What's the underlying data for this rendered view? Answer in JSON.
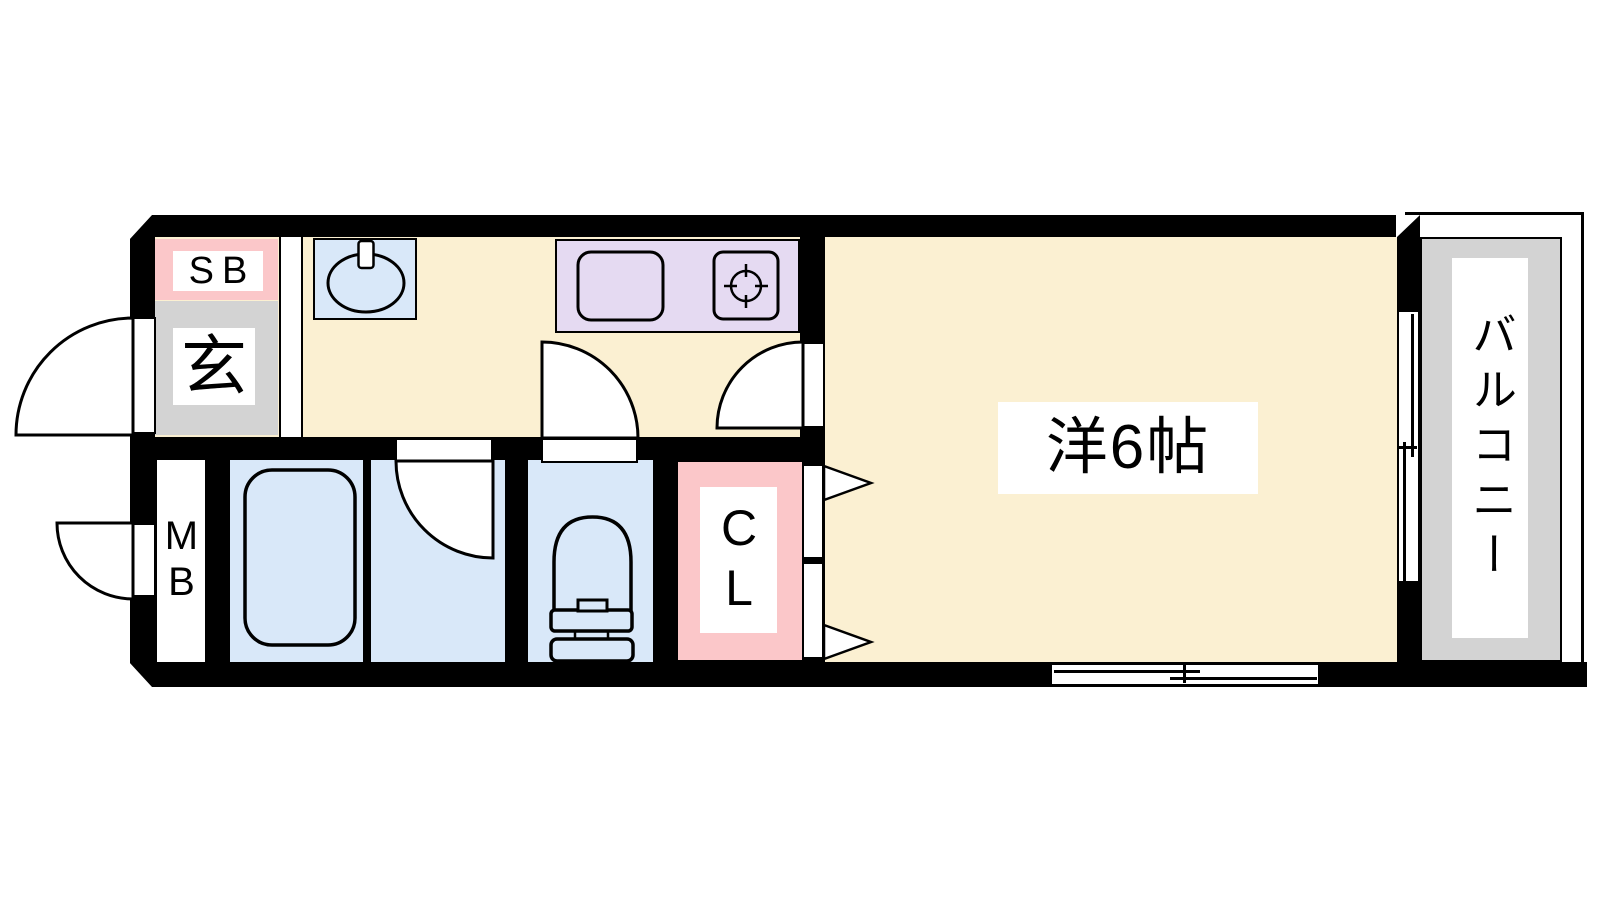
{
  "labels": {
    "shoe_box": "SB",
    "entrance": "玄",
    "meter_box": "MB",
    "closet": "CL",
    "bedroom": "洋6帖",
    "balcony": "バルコニー"
  },
  "colors": {
    "bg": "#FFFFFF",
    "wall": "#000000",
    "floor": "#FBF0D2",
    "water": "#D9E8F9",
    "kitchen": "#E5DAF2",
    "pink": "#FBC7C9",
    "gray": "#D3D3D3"
  },
  "icons": {
    "wash_basin": "basin-oval-with-tap",
    "kitchen_sink": "rounded-rect-sink",
    "stove": "burner-circle-with-ticks",
    "bathtub": "rounded-rect-tub",
    "toilet": "toilet-bowl-tank",
    "swing_doors": "quarter-circle-arc",
    "closet_doors": "bifold-triangles",
    "sliding_window": "double-rail-slider"
  }
}
